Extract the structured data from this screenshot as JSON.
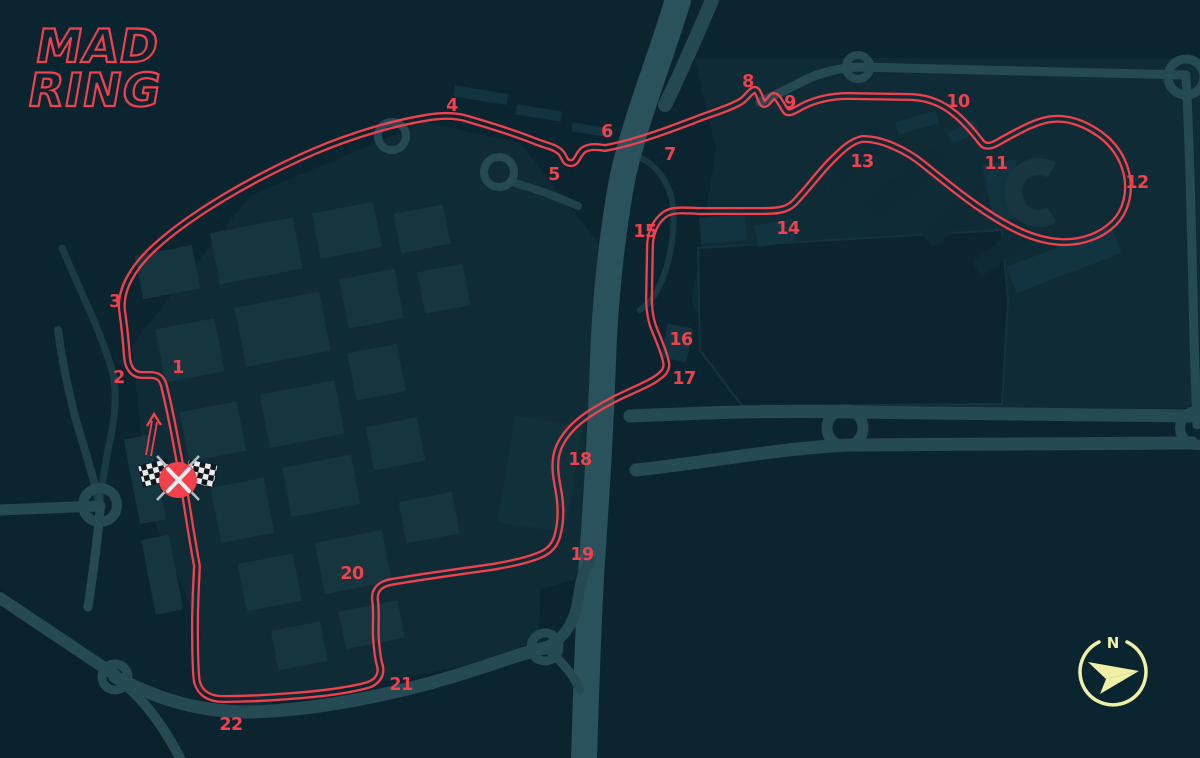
{
  "title": "MADRING circuit map",
  "logo": {
    "line1": "MAD",
    "line2": "RING"
  },
  "track": {
    "name": "circuit-outline",
    "color": "#f2414d",
    "path": "M 197,566 C 192,540 187,505 181,470 C 176,442 170,410 164,386 C 162,378 158,375 150,375 L 142,375 C 133,375 128,368 127,357 C 126,342 124,324 122,310 C 120,290 132,268 155,247 C 190,215 252,178 315,151 C 355,134 395,123 425,118 C 442,115 456,115 468,119 C 492,126 515,133 537,142 C 548,146 554,147 559,151 C 565,155 563,162 570,163 C 578,164 577,153 585,149 C 591,146 598,147 605,148 C 633,143 663,132 692,121 C 712,113 728,109 740,102 C 747,98 749,92 754,90 C 758,89 759,96 762,102 C 764,107 768,102 772,97 C 776,93 780,102 785,110 C 788,115 794,111 801,107 C 816,99 832,96 848,96 L 912,97 C 931,98 944,105 955,114 C 965,122 974,133 981,142 C 986,149 994,145 1002,140 C 1020,130 1038,120 1053,119 C 1072,117 1092,127 1106,139 C 1117,149 1124,161 1127,176 C 1130,193 1126,211 1114,223 C 1101,236 1081,243 1061,242 C 1041,241 1021,233 1004,223 C 974,206 948,184 923,164 C 906,150 880,138 862,139 C 851,141 841,151 831,161 C 819,173 806,191 794,203 C 786,211 774,211 761,211 L 702,211 C 687,211 673,208 664,215 C 655,222 651,232 650,244 L 649,298 C 649,312 651,322 655,331 C 659,341 664,352 666,362 C 668,370 662,375 654,380 C 642,387 626,393 613,400 C 596,409 581,418 571,429 C 563,438 558,446 556,457 C 554,470 557,482 559,494 C 561,507 561,521 558,533 C 556,544 550,551 540,555 C 528,560 510,564 492,567 C 456,572 420,577 391,582 C 380,584 374,590 375,600 C 377,613 375,626 376,639 C 377,652 378,660 380,666 C 382,675 377,682 368,685 C 350,690 320,694 291,696 C 267,698 242,699 223,699 C 209,699 200,693 197,682 C 195,672 195,645 195,625 C 195,605 196,585 197,566 Z"
  },
  "corners": [
    {
      "n": "1",
      "x": 178,
      "y": 367
    },
    {
      "n": "2",
      "x": 119,
      "y": 377
    },
    {
      "n": "3",
      "x": 115,
      "y": 301
    },
    {
      "n": "4",
      "x": 452,
      "y": 105
    },
    {
      "n": "5",
      "x": 554,
      "y": 174
    },
    {
      "n": "6",
      "x": 607,
      "y": 131
    },
    {
      "n": "7",
      "x": 670,
      "y": 154
    },
    {
      "n": "8",
      "x": 748,
      "y": 81
    },
    {
      "n": "9",
      "x": 790,
      "y": 102
    },
    {
      "n": "10",
      "x": 958,
      "y": 101
    },
    {
      "n": "11",
      "x": 996,
      "y": 163
    },
    {
      "n": "12",
      "x": 1137,
      "y": 182
    },
    {
      "n": "13",
      "x": 862,
      "y": 161
    },
    {
      "n": "14",
      "x": 788,
      "y": 228
    },
    {
      "n": "15",
      "x": 645,
      "y": 231
    },
    {
      "n": "16",
      "x": 681,
      "y": 339
    },
    {
      "n": "17",
      "x": 684,
      "y": 378
    },
    {
      "n": "18",
      "x": 580,
      "y": 459
    },
    {
      "n": "19",
      "x": 582,
      "y": 554
    },
    {
      "n": "20",
      "x": 352,
      "y": 573
    },
    {
      "n": "21",
      "x": 401,
      "y": 684
    },
    {
      "n": "22",
      "x": 231,
      "y": 724
    }
  ],
  "start_finish": {
    "symbol": "crossed-checkered-flags",
    "x": 178,
    "y": 480,
    "direction": "north"
  },
  "compass": {
    "north_label": "N"
  },
  "colors": {
    "background": "#0b2530",
    "district": "#0f2c36",
    "park": "#0b2430",
    "building": "#16363f",
    "building_dark": "#0d2a35",
    "building_light": "#123340",
    "road": "#254a54",
    "highway": "#2a525c",
    "track": "#f2414d",
    "label": "#f2414d",
    "compass": "#eff0a6"
  }
}
